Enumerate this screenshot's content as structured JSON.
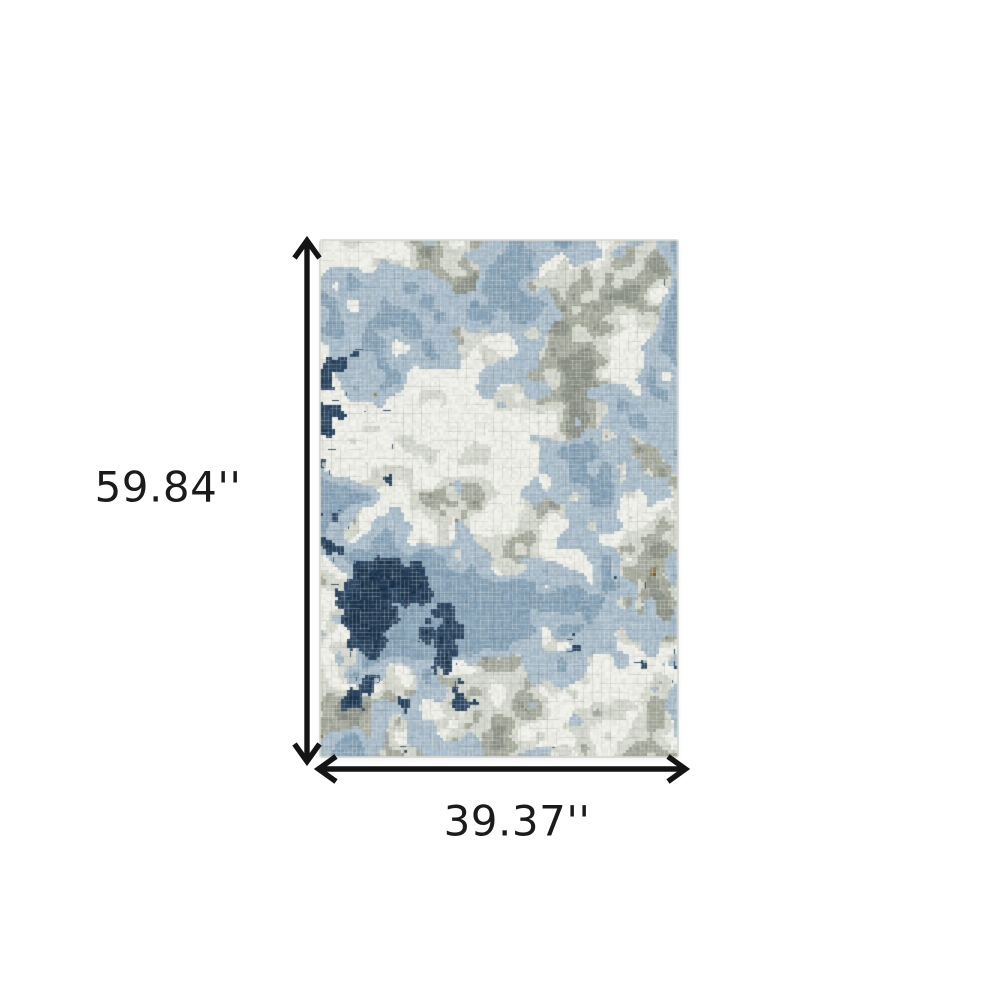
{
  "dimensions": {
    "height": {
      "label": "59.84''"
    },
    "width": {
      "label": "39.37''"
    }
  },
  "annotation": {
    "arrow_color": "#141414",
    "label_color": "#1b1b1b"
  },
  "rug": {
    "seed": 12345,
    "palette": {
      "cream": "#ecede6",
      "light_gray": "#d3d6cc",
      "gray_green": "#a6aa9d",
      "dark_gray": "#8e9389",
      "light_blue": "#a8bcca",
      "slate_blue": "#87a3b7",
      "navy": "#2c4763",
      "dark_navy": "#1f3952",
      "amber": "#9d7c3e",
      "rust": "#8a5d28",
      "worn_white": "#f2f3ec"
    }
  }
}
